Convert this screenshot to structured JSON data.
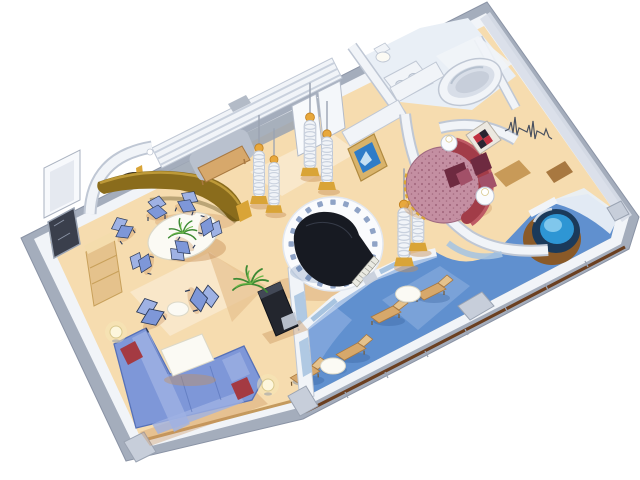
{
  "figure": {
    "type": "isometric cruise suite floor plan illustration",
    "background": "#FFFFFF"
  },
  "scene": {
    "rooms": [
      {
        "name": "living-room",
        "items": [
          "sectional-sofa",
          "red-pillows",
          "coffee-table",
          "armchairs",
          "side-table",
          "floor-lamps",
          "tv-cabinet",
          "palm-plant"
        ]
      },
      {
        "name": "dining-area",
        "items": [
          "round-dining-table",
          "dining-chairs-x6",
          "centerpiece-plant",
          "curved-bar-counter",
          "bar-niche-lamp",
          "sideboard",
          "wall-mirror",
          "open-entry-door"
        ]
      },
      {
        "name": "entry-hall",
        "items": [
          "louvered-wardrobe",
          "entry-rug",
          "wood-bench",
          "spiral-columns-x4",
          "open-double-doors",
          "wall-vent"
        ]
      },
      {
        "name": "piano-lounge",
        "items": [
          "circular-platform",
          "mosaic-tile-ring",
          "grand-piano",
          "piano-keyboard",
          "spiral-columns-x2"
        ]
      },
      {
        "name": "bedroom",
        "items": [
          "round-bed",
          "crescent-headboard",
          "maroon-pillows",
          "folded-blanket",
          "nightstands-x2",
          "checkered-artwork",
          "wall-tv",
          "ekg-wall-art",
          "vanity-desk-wedges"
        ]
      },
      {
        "name": "bathroom",
        "items": [
          "oval-bathtub",
          "double-sink-vanity",
          "toilet"
        ]
      },
      {
        "name": "balcony",
        "items": [
          "blue-deck",
          "wood-railing",
          "lounge-chairs-x4",
          "round-deck-tables-x2",
          "privacy-divider",
          "hot-tub"
        ]
      }
    ]
  },
  "palette": {
    "bg": "#FFFFFF",
    "trim": "#A4ADBC",
    "trimEdge": "#8A93A5",
    "wall": "#F1F4F8",
    "wallShade": "#D8DEE8",
    "wallEdge": "#BFC7D4",
    "grayMid": "#9AA3B2",
    "grayLight": "#C7CEDA",
    "floor": "#F6DCAF",
    "floorL": "#FBEDD7",
    "floorS": "#E7C18F",
    "deck": "#6090CF",
    "deckL": "#93B3E2",
    "deckP": "#C9D9F0",
    "deckW": "#E9EFF6",
    "deckSh": "#2E5A96",
    "rail": "#6B3F20",
    "railWood": "#C49A5E",
    "sofa": "#7E97D8",
    "sofaL": "#9FB2E4",
    "sofaD": "#5671B8",
    "navy": "#2C3A58",
    "red": "#A43A42",
    "bar": "#8A6C1C",
    "barLight": "#BE9A38",
    "barDark": "#4E3E0E",
    "nook": "#241E14",
    "tan": "#D7A86B",
    "tanL": "#E5C28C",
    "tanD": "#A87840",
    "tanTop": "#F4DCAC",
    "white": "#FBFAF4",
    "whiteEdge": "#DBD8C8",
    "piano": "#171A22",
    "pianoLine": "#3A3F4C",
    "keys": "#EAEAE2",
    "plat": "#FAFBFD",
    "platEdge": "#E2E7EF",
    "tile": "#8FA3C6",
    "bed": "#C48FA2",
    "bedEdge": "#A06A80",
    "bedDot": "#9A5F76",
    "head": "#A23C48",
    "headL": "#BE5A64",
    "maroon": "#6E2A40",
    "maroonL": "#A25068",
    "gold": "#D9A437",
    "cap": "#E8A83C",
    "capEdge": "#C07F1E",
    "tubN": "#1B3A5A",
    "water": "#2E96D4",
    "waterL": "#8ED0F0",
    "ring": "#8A5A28",
    "green": "#3E8A34",
    "greenL": "#6AB648",
    "lampGlow": "#F6E8B8",
    "lampShade": "#FDF6DC",
    "tvG": "#D9B36A",
    "tvGD": "#B08A40",
    "tvB": "#2E7CC8",
    "tvSky": "#D8ECF8",
    "artR": "#C03040",
    "artD": "#2A2430",
    "artF": "#ECE8E0",
    "ekg": "#4A5160",
    "glass": "#A8C4E0",
    "shadow": "#C89058",
    "cab": "#23262E"
  }
}
